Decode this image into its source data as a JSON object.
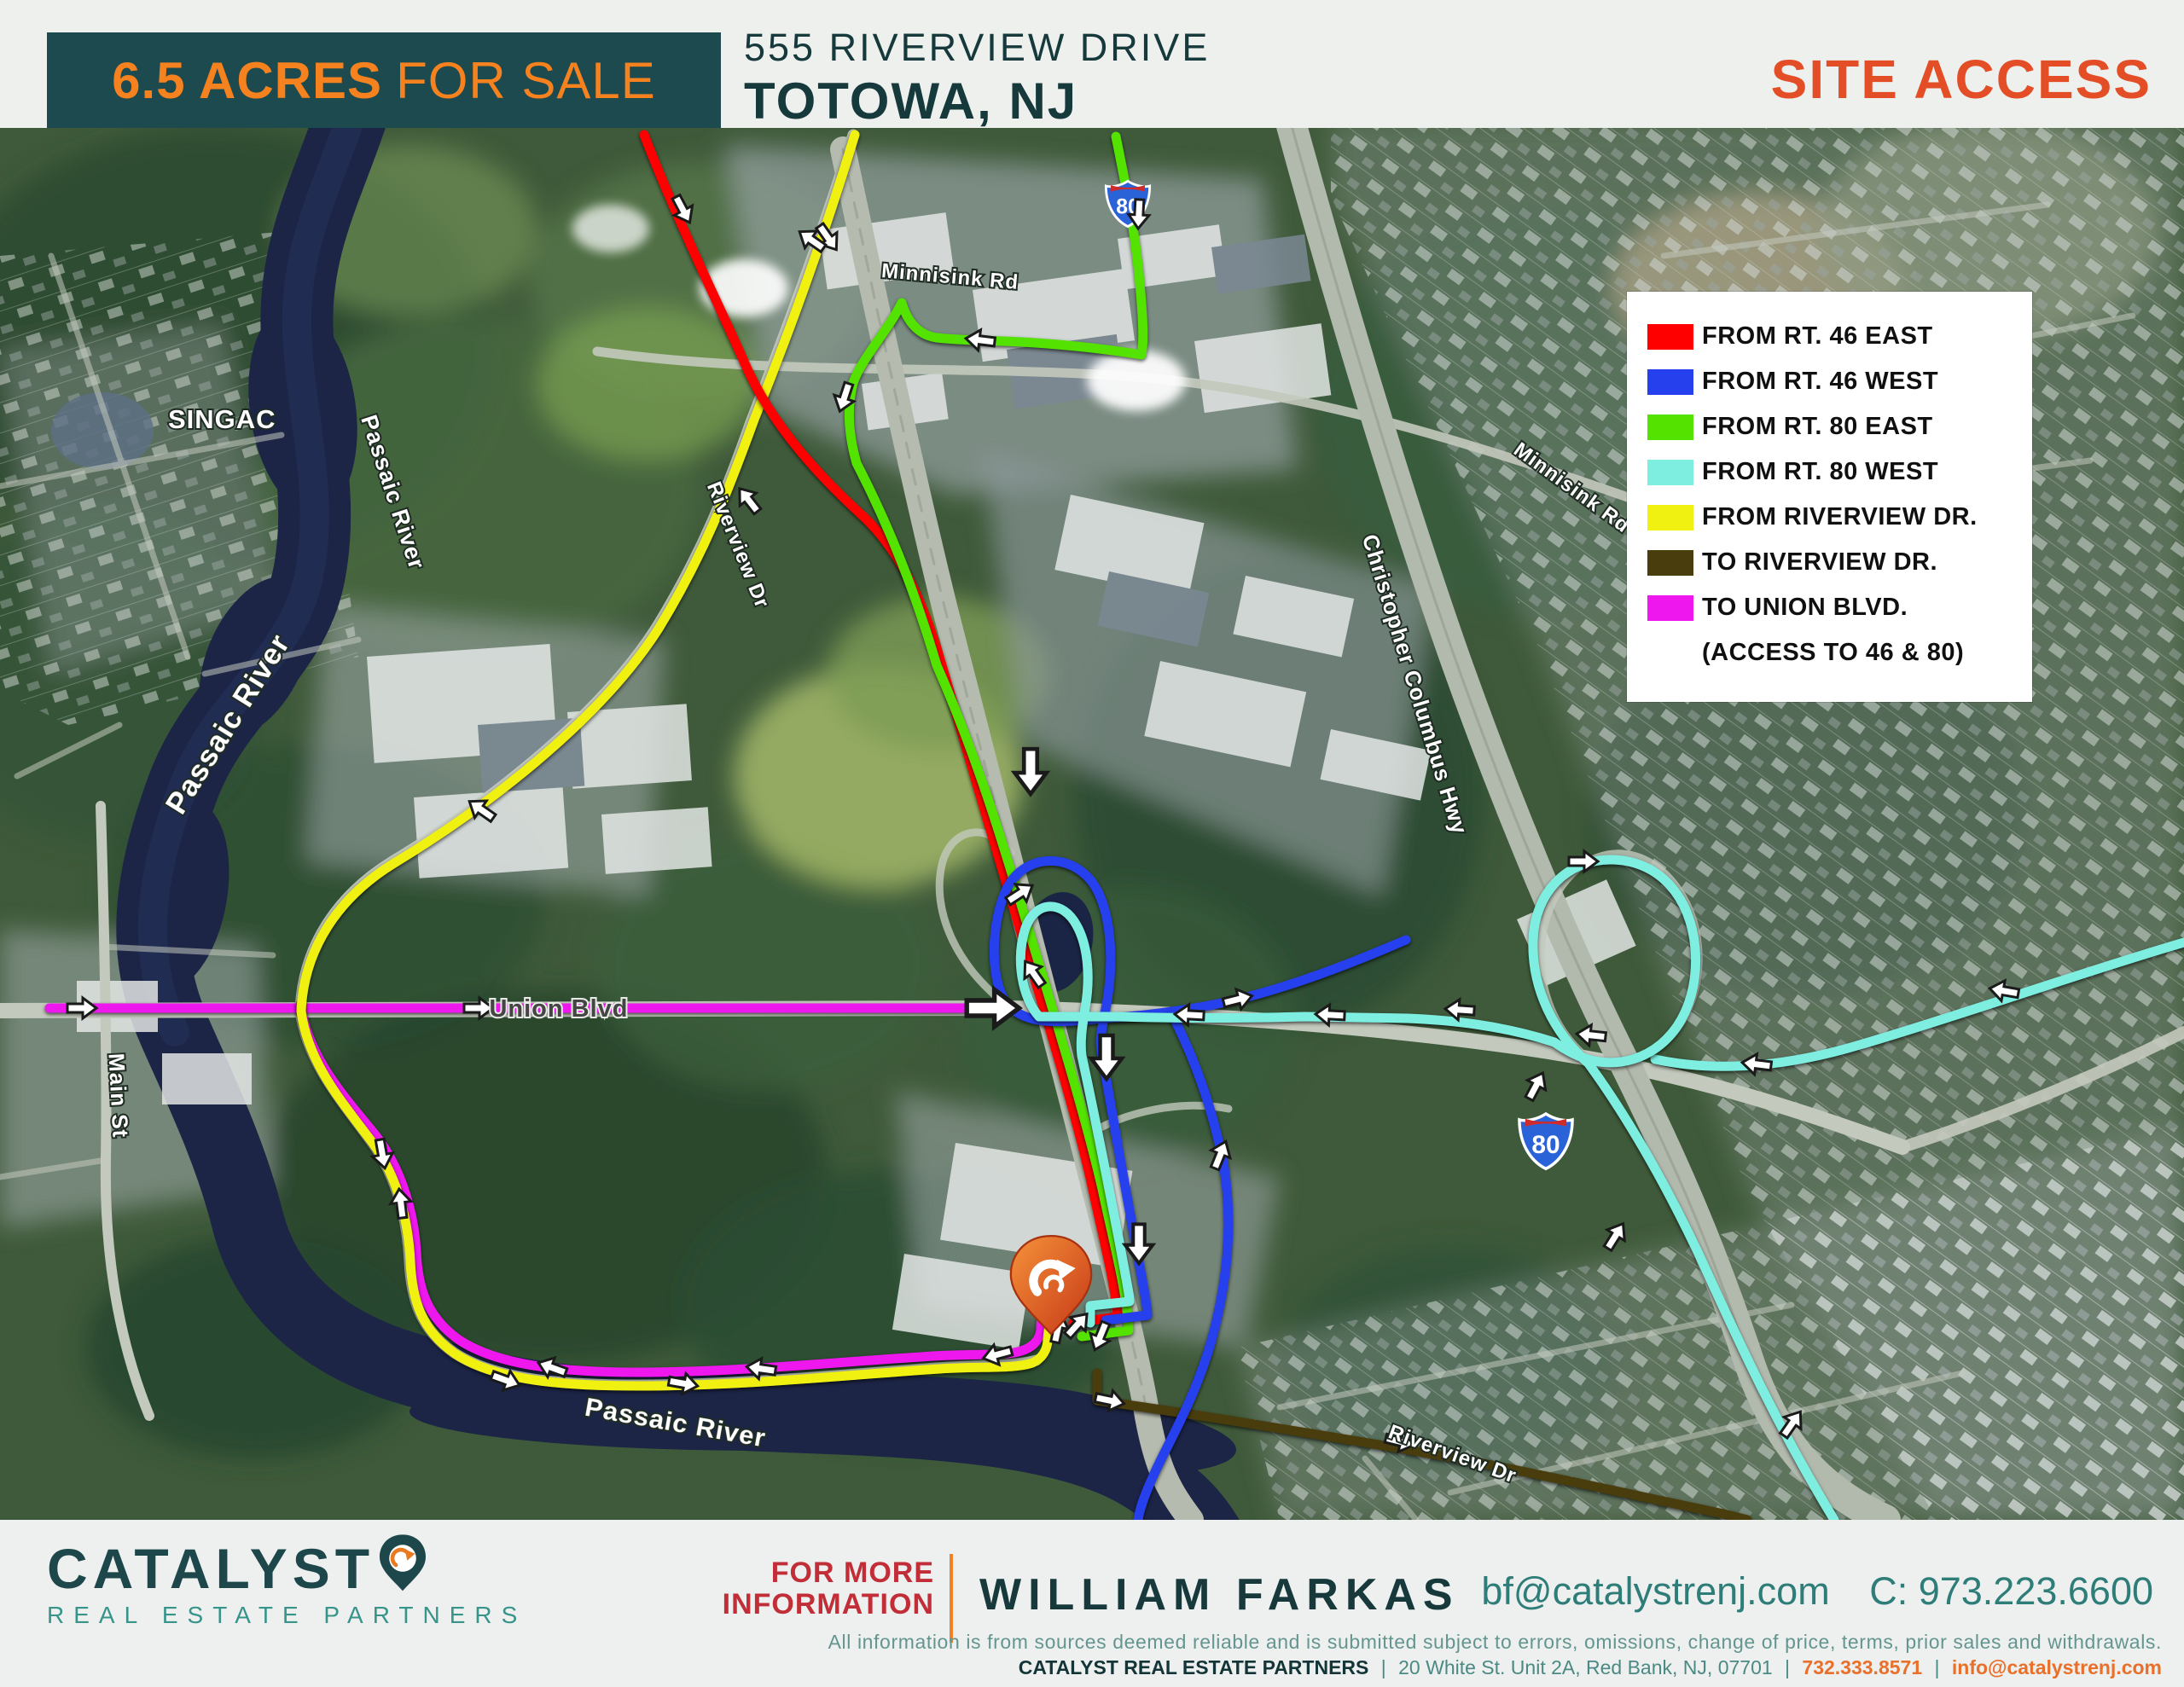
{
  "header": {
    "banner_acres": "6.5 ACRES",
    "banner_for_sale": "FOR SALE",
    "address_line1": "555 RIVERVIEW DRIVE",
    "address_line2": "TOTOWA, NJ",
    "page_label": "SITE ACCESS"
  },
  "legend": {
    "items": [
      {
        "label": "FROM RT. 46 EAST",
        "color": "#fe0000"
      },
      {
        "label": "FROM RT. 46 WEST",
        "color": "#2640ee"
      },
      {
        "label": "FROM RT. 80 EAST",
        "color": "#54e200"
      },
      {
        "label": "FROM RT. 80 WEST",
        "color": "#7deee0"
      },
      {
        "label": "FROM RIVERVIEW DR.",
        "color": "#f0f011"
      },
      {
        "label": "TO RIVERVIEW DR.",
        "color": "#493c0d"
      },
      {
        "label": "TO UNION BLVD.",
        "color": "#ee17ee"
      }
    ],
    "note": "(ACCESS TO 46 & 80)"
  },
  "map": {
    "labels": {
      "singac": "SINGAC",
      "passaic_river": "Passaic River",
      "main_st": "Main St",
      "union_blvd": "Union Blvd",
      "christopher_columbus_hwy": "Christopher Columbus Hwy",
      "minnisink_rd": "Minnisink Rd",
      "riverview_dr": "Riverview Dr"
    },
    "shield_80": "80"
  },
  "footer": {
    "brand_name": "CATALYST",
    "brand_sub": "REAL ESTATE PARTNERS",
    "info_line1": "FOR MORE",
    "info_line2": "INFORMATION",
    "agent_name": "WILLIAM FARKAS",
    "agent_email": "bf@catalystrenj.com",
    "agent_phone": "C: 973.223.6600",
    "disclaimer": "All information is from sources deemed reliable and is submitted subject to errors, omissions, change of price, terms, prior sales and withdrawals.",
    "company_name": "CATALYST REAL ESTATE PARTNERS",
    "company_address": "20 White St. Unit 2A, Red Bank, NJ, 07701",
    "company_phone": "732.333.8571",
    "company_email": "info@catalystrenj.com",
    "separator": "|"
  }
}
